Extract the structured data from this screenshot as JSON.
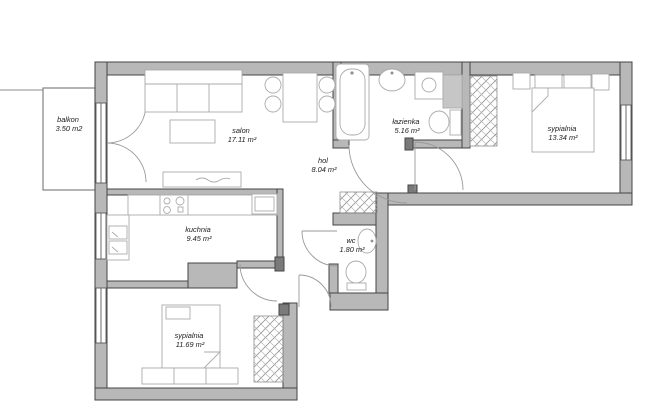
{
  "plan": {
    "type": "apartment-floor-plan",
    "rooms": [
      {
        "id": "balkon",
        "name": "balkon",
        "area": "3.50 m2"
      },
      {
        "id": "salon",
        "name": "salon",
        "area": "17.11 m²"
      },
      {
        "id": "hol",
        "name": "hol",
        "area": "8.04 m²"
      },
      {
        "id": "lazienka",
        "name": "łazienka",
        "area": "5.16 m²"
      },
      {
        "id": "sypialnia1",
        "name": "sypialnia",
        "area": "13.34 m²"
      },
      {
        "id": "kuchnia",
        "name": "kuchnia",
        "area": "9.45 m²"
      },
      {
        "id": "wc",
        "name": "wc",
        "area": "1.80 m²"
      },
      {
        "id": "sypialnia2",
        "name": "sypialnia",
        "area": "11.69 m²"
      }
    ],
    "colors": {
      "wall": "#b8b8b8",
      "wall_outline": "#454545",
      "furniture_line": "#a8a8a8",
      "door_arc": "#9a9a9a",
      "background": "#ffffff",
      "text": "#1c1c1c"
    }
  }
}
